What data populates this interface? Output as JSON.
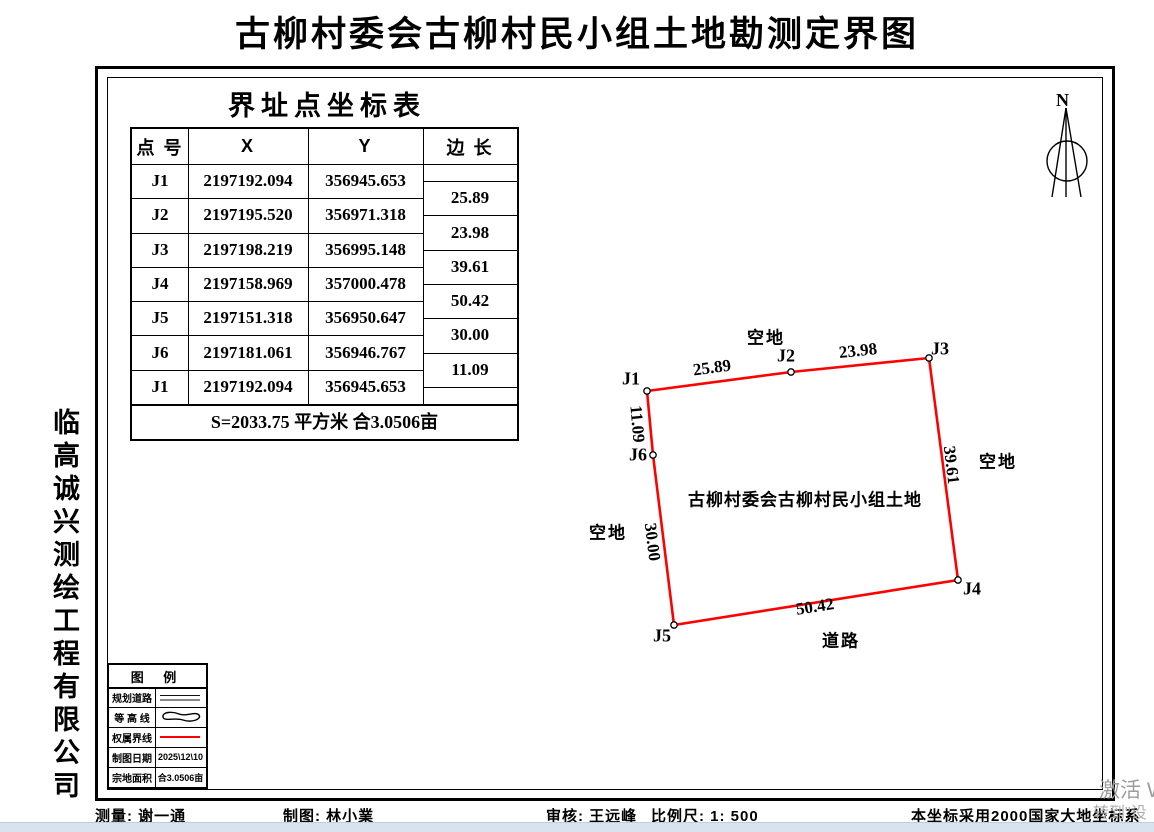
{
  "title": "古柳村委会古柳村民小组土地勘测定界图",
  "company_vertical": "临高诚兴测绘工程有限公司",
  "coordinate_table": {
    "title": "界址点坐标表",
    "headers": [
      "点 号",
      "X",
      "Y",
      "边 长"
    ],
    "rows": [
      {
        "id": "J1",
        "x": "2197192.094",
        "y": "356945.653"
      },
      {
        "id": "J2",
        "x": "2197195.520",
        "y": "356971.318"
      },
      {
        "id": "J3",
        "x": "2197198.219",
        "y": "356995.148"
      },
      {
        "id": "J4",
        "x": "2197158.969",
        "y": "357000.478"
      },
      {
        "id": "J5",
        "x": "2197151.318",
        "y": "356950.647"
      },
      {
        "id": "J6",
        "x": "2197181.061",
        "y": "356946.767"
      },
      {
        "id": "J1",
        "x": "2197192.094",
        "y": "356945.653"
      }
    ],
    "edge_lengths": [
      "25.89",
      "23.98",
      "39.61",
      "50.42",
      "30.00",
      "11.09"
    ],
    "summary": "S=2033.75 平方米 合3.0506亩"
  },
  "map": {
    "north_label": "N",
    "boundary_color": "#fe0000",
    "parcel_label": {
      "text": "古柳村委会古柳村民小组土地",
      "x": 805,
      "y": 498
    },
    "vertices": [
      {
        "name": "J1",
        "px": 647,
        "py": 391,
        "lx": 631,
        "ly": 379
      },
      {
        "name": "J2",
        "px": 791,
        "py": 372,
        "lx": 786,
        "ly": 356
      },
      {
        "name": "J3",
        "px": 929,
        "py": 358,
        "lx": 940,
        "ly": 349
      },
      {
        "name": "J4",
        "px": 958,
        "py": 580,
        "lx": 972,
        "ly": 589
      },
      {
        "name": "J5",
        "px": 674,
        "py": 625,
        "lx": 662,
        "ly": 636
      },
      {
        "name": "J6",
        "px": 653,
        "py": 455,
        "lx": 638,
        "ly": 455
      }
    ],
    "edge_labels": [
      {
        "text": "25.89",
        "x": 712,
        "y": 368,
        "rot": -7.5
      },
      {
        "text": "23.98",
        "x": 858,
        "y": 351,
        "rot": -6
      },
      {
        "text": "39.61",
        "x": 951,
        "y": 465,
        "rot": 83
      },
      {
        "text": "50.42",
        "x": 815,
        "y": 607,
        "rot": -9
      },
      {
        "text": "30.00",
        "x": 652,
        "y": 542,
        "rot": 83
      },
      {
        "text": "11.09",
        "x": 637,
        "y": 424,
        "rot": 85
      }
    ],
    "surroundings": [
      {
        "label": "空地",
        "x": 766,
        "y": 336
      },
      {
        "label": "空地",
        "x": 998,
        "y": 460
      },
      {
        "label": "空地",
        "x": 608,
        "y": 531
      },
      {
        "label": "道路",
        "x": 841,
        "y": 639
      }
    ]
  },
  "legend": {
    "title": "图    例",
    "rows": [
      {
        "label": "规划道路",
        "symbol": "double-line",
        "value": ""
      },
      {
        "label": "等 高 线",
        "symbol": "contour",
        "value": ""
      },
      {
        "label": "权属界线",
        "symbol": "red-line",
        "value": ""
      },
      {
        "label": "制图日期",
        "symbol": "text",
        "value": "2025\\12\\10"
      },
      {
        "label": "宗地面积",
        "symbol": "text",
        "value": "合3.0506亩"
      }
    ]
  },
  "footer": {
    "surveyor": "测量: 谢一通",
    "drafter": "制图: 林小業",
    "reviewer": "审核: 王远峰",
    "scale": "比例尺: 1: 500",
    "datum": "本坐标采用2000国家大地坐标系"
  },
  "watermark": {
    "line1": "激活 W",
    "line2": "转到\"设"
  }
}
